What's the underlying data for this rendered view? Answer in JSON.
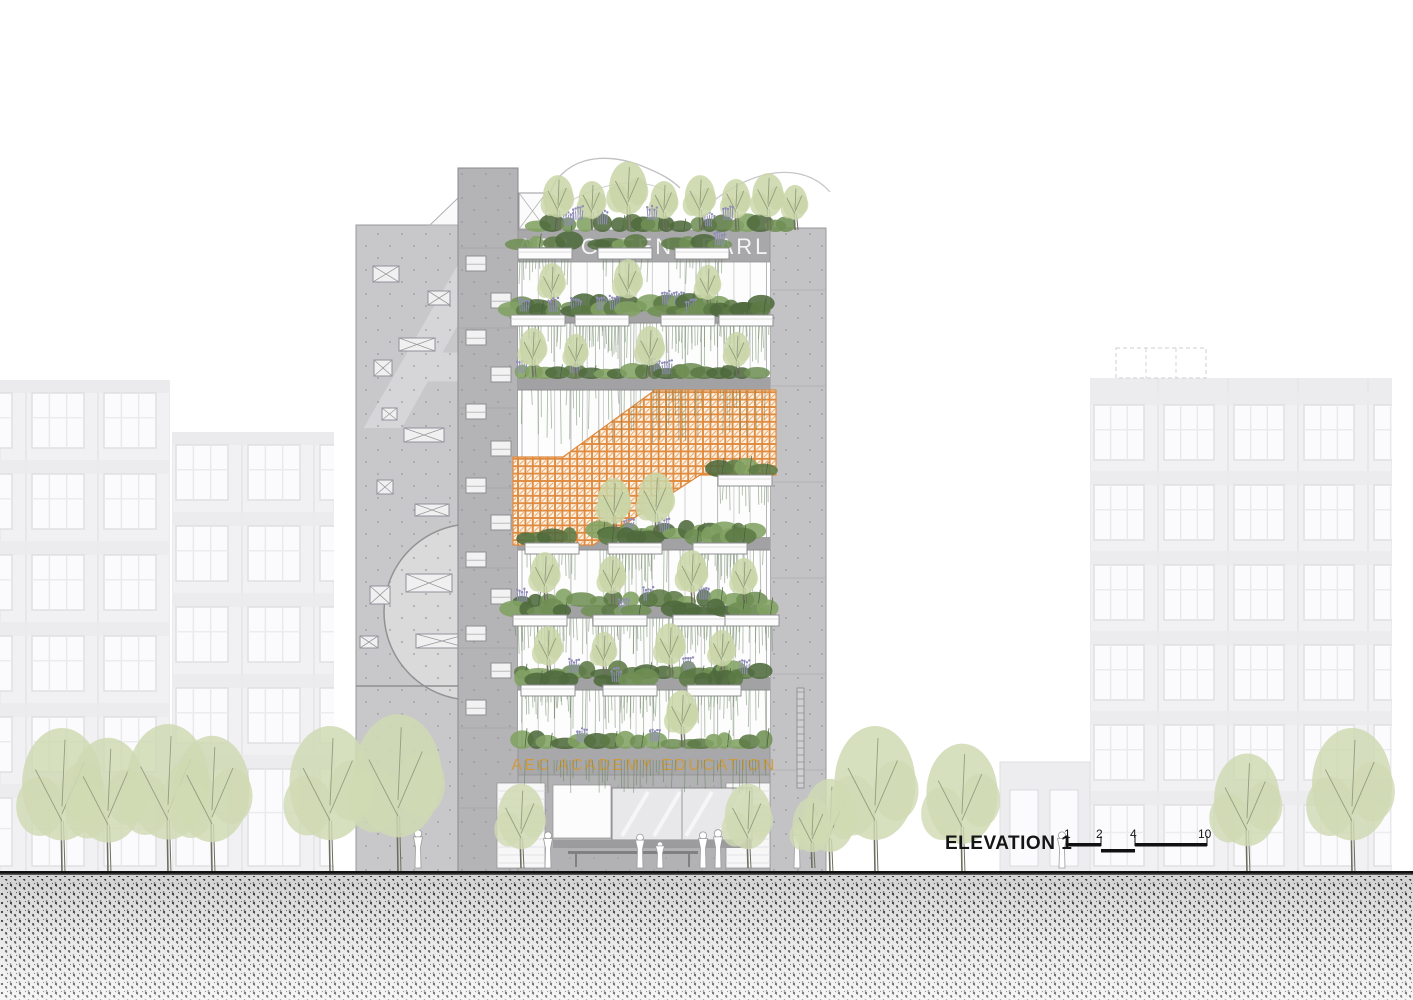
{
  "building": {
    "rooftop_sign": "AEC GREEN PEARL",
    "podium_sign": "AEC ACADEMY EDUCATION"
  },
  "annotation": {
    "label": "ELEVATION 1",
    "ticks": [
      "1",
      "2",
      "4",
      "10"
    ]
  },
  "colors": {
    "sign_top": "#f5f5f5",
    "sign_podium": "#cf9a3d",
    "annotation_text": "#151515",
    "orange_screen": "#df8a3e",
    "concrete_left": "#c8c8ca",
    "concrete_tower": "#b4b4b6",
    "concrete_right": "#c3c3c5",
    "slab": "#a2a2a4",
    "band": "#a8a8aa",
    "ground_floor": "#b2b2b4",
    "bg_wall": "#f1f1f3",
    "bg_window": "#fbfbfd",
    "bg_frame": "#dcdce0",
    "tree_street": "#cfd9b3",
    "tree_terrace": "#c9d6a7",
    "purple_flower": "#8f8cba",
    "vine": "rgba(96,126,86,0.5)",
    "branch": "#8d977b",
    "trunk": "#6e6e60",
    "shrubs": [
      "#5c7a45",
      "#6f8f54",
      "#82a263",
      "#4e6a3c"
    ]
  },
  "scene": {
    "width": 1413,
    "height": 1000,
    "groundY": 873,
    "leftWall": {
      "x": 356,
      "y": 225,
      "w": 102
    },
    "tower": {
      "x": 458,
      "y": 168,
      "w": 60
    },
    "rightWall": {
      "x": 770,
      "y": 228,
      "w": 56
    },
    "facade": {
      "x": 518,
      "y": 262,
      "w": 252,
      "bottom": 747
    },
    "titleBand": {
      "x": 518,
      "y": 230,
      "w": 252,
      "h": 32
    },
    "academyBand": {
      "x": 518,
      "y": 747,
      "w": 252,
      "h": 28
    },
    "slabs": [
      310,
      377,
      537,
      605,
      677
    ],
    "orangePoints": "513,457 563,457 655,390 776,390 776,475 700,475 593,545 513,545",
    "levels": [
      {
        "y": 310,
        "x0": 522,
        "x1": 766,
        "vmax": 42,
        "planters": [
          545,
          625,
          702
        ],
        "trees": [
          [
            552,
            48
          ],
          [
            628,
            52
          ],
          [
            708,
            46
          ]
        ]
      },
      {
        "y": 377,
        "x0": 522,
        "x1": 766,
        "vmax": 46,
        "planters": [
          538,
          602,
          688,
          746
        ],
        "trees": [
          [
            533,
            50
          ],
          [
            576,
            44
          ],
          [
            650,
            52
          ],
          [
            737,
            46
          ]
        ]
      },
      {
        "y": 537,
        "x0": 600,
        "x1": 766,
        "vmax": 44,
        "planters": [
          745
        ],
        "trees": [
          [
            614,
            60
          ],
          [
            656,
            66
          ]
        ]
      },
      {
        "y": 605,
        "x0": 522,
        "x1": 766,
        "vmax": 42,
        "planters": [
          552,
          635,
          720
        ],
        "trees": [
          [
            545,
            54
          ],
          [
            612,
            50
          ],
          [
            692,
            56
          ],
          [
            744,
            48
          ]
        ]
      },
      {
        "y": 677,
        "x0": 522,
        "x1": 766,
        "vmax": 40,
        "planters": [
          540,
          620,
          700,
          752
        ],
        "trees": [
          [
            548,
            52
          ],
          [
            604,
            46
          ],
          [
            670,
            55
          ],
          [
            722,
            48
          ]
        ]
      },
      {
        "y": 747,
        "x0": 522,
        "x1": 766,
        "vmax": 26,
        "planters": [
          548,
          630,
          714
        ],
        "trees": [
          [
            682,
            58
          ]
        ]
      }
    ],
    "roof": {
      "y": 230,
      "x0": 538,
      "x1": 798,
      "trees": [
        [
          558,
          56
        ],
        [
          592,
          50
        ],
        [
          628,
          70
        ],
        [
          664,
          50
        ],
        [
          700,
          56
        ],
        [
          736,
          52
        ],
        [
          768,
          58
        ],
        [
          795,
          46
        ]
      ]
    },
    "towerWindows": {
      "startY": 256,
      "step": 37,
      "count": 13,
      "xLeft": 466,
      "xRight": 491,
      "w": 20,
      "h": 15
    },
    "leftWallWindows": [
      [
        373,
        266,
        26,
        16
      ],
      [
        428,
        291,
        22,
        14
      ],
      [
        399,
        338,
        36,
        13
      ],
      [
        374,
        360,
        18,
        16
      ],
      [
        382,
        408,
        15,
        12
      ],
      [
        404,
        428,
        40,
        14
      ],
      [
        377,
        480,
        16,
        14
      ],
      [
        415,
        504,
        34,
        12
      ],
      [
        370,
        586,
        20,
        18
      ],
      [
        406,
        574,
        46,
        18
      ],
      [
        360,
        636,
        18,
        12
      ],
      [
        416,
        634,
        52,
        14
      ]
    ],
    "bgBuildings": [
      {
        "x": -40,
        "clip": [
          0,
          170
        ],
        "top": 380,
        "bayW": 72,
        "winW": 52,
        "floorH": 81,
        "rows": 6,
        "firstRow": 393
      },
      {
        "x": 176,
        "clip": [
          172,
          334
        ],
        "top": 432,
        "bayW": 72,
        "winW": 52,
        "floorH": 81,
        "rows": 5,
        "firstRow": 445
      },
      {
        "x": 1094,
        "clip": [
          1090,
          1392
        ],
        "top": 378,
        "bayW": 70,
        "winW": 50,
        "floorH": 80,
        "rows": 6,
        "firstRow": 405
      }
    ],
    "dashedRoof": {
      "x": 1116,
      "y": 348,
      "w": 90,
      "h": 30
    },
    "lowWing": {
      "x": 1000,
      "y": 762,
      "w": 90
    },
    "streetTrees": [
      [
        62,
        148
      ],
      [
        108,
        138
      ],
      [
        168,
        152
      ],
      [
        212,
        140
      ],
      [
        330,
        150
      ],
      [
        398,
        162
      ],
      [
        830,
        96
      ],
      [
        875,
        150
      ],
      [
        962,
        132
      ],
      [
        1247,
        122
      ],
      [
        1352,
        148
      ]
    ],
    "entranceTrees": [
      [
        521,
        86
      ],
      [
        748,
        86
      ],
      [
        812,
        72
      ]
    ],
    "people": [
      [
        548,
        36
      ],
      [
        640,
        34
      ],
      [
        660,
        27
      ],
      [
        703,
        36
      ],
      [
        718,
        38
      ],
      [
        797,
        40
      ],
      [
        1062,
        36
      ],
      [
        418,
        38
      ]
    ],
    "groundDetail": {
      "whiteStrips": [
        [
          497,
          783,
          48,
          85
        ],
        [
          726,
          783,
          44,
          85
        ]
      ],
      "signRect": [
        553,
        785,
        58,
        53
      ],
      "glass": [
        612,
        788,
        140,
        52
      ],
      "fascia": [
        553,
        840,
        199,
        8
      ],
      "bench": [
        568,
        698
      ]
    },
    "scaleBar": {
      "yHigh": 843,
      "yLow": 849,
      "segA": [
        1068,
        1101
      ],
      "segB": [
        1101,
        1135
      ],
      "segC": [
        1135,
        1207
      ],
      "tickX": [
        1068,
        1101,
        1135,
        1207
      ],
      "labelX": [
        1064,
        1096,
        1130,
        1198
      ],
      "labelY": 838
    }
  }
}
